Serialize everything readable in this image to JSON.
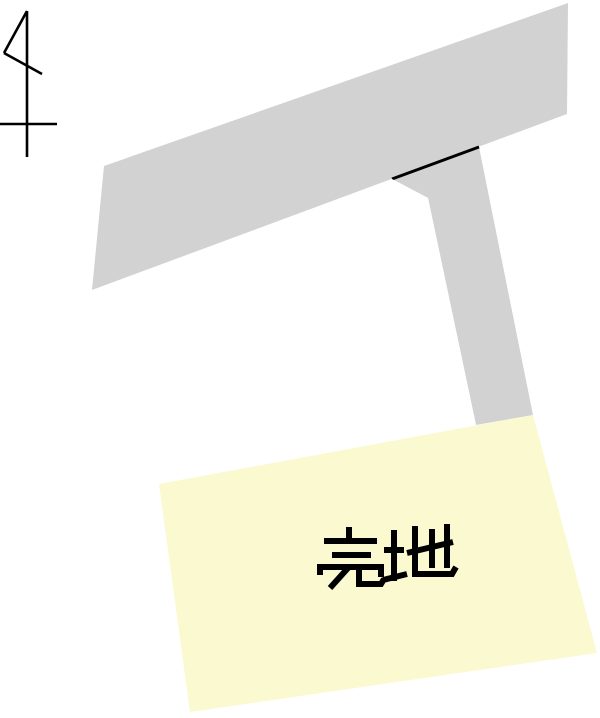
{
  "map": {
    "background_color": "#ffffff",
    "outline_color": "#000000",
    "road": {
      "color": "#d2d2d2"
    },
    "vacant_lot": {
      "color": "#ffffff"
    },
    "sale_lot": {
      "color": "#fbf9d0",
      "label": "売地",
      "label_color": "#000000"
    },
    "compass": {
      "color": "#000000"
    }
  }
}
